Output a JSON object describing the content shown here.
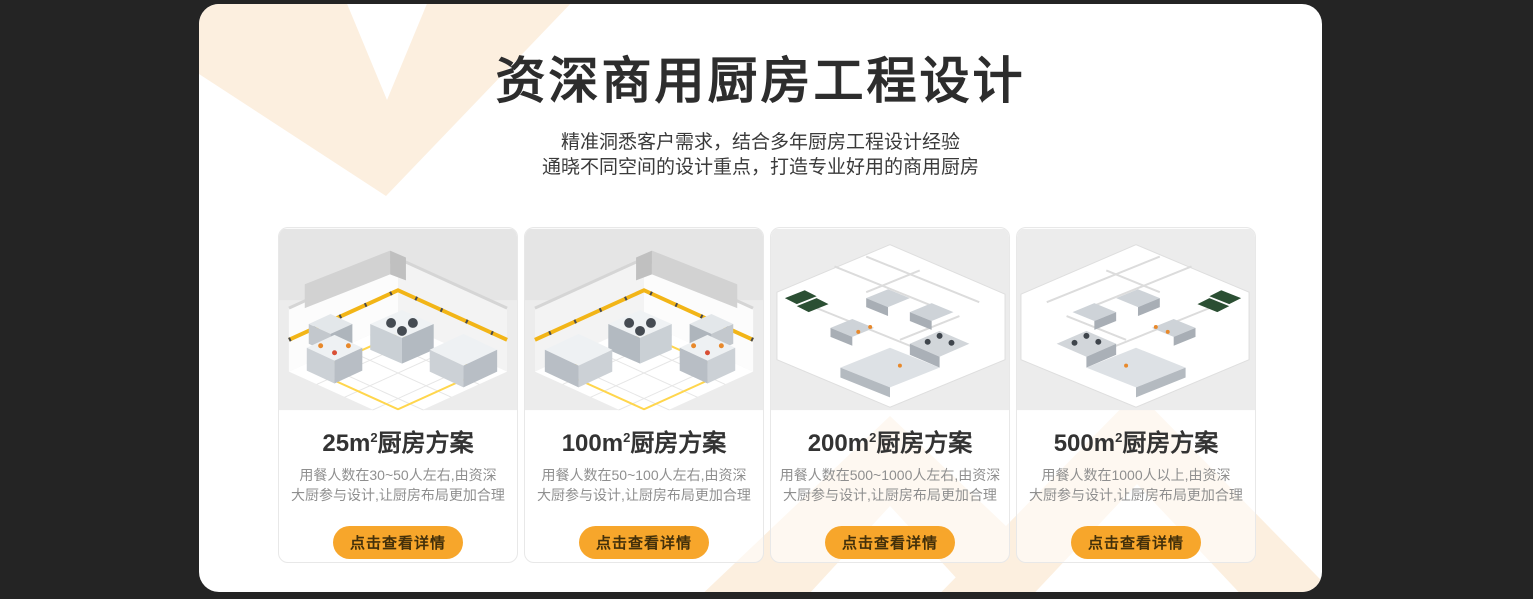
{
  "theme": {
    "page_background": "#242424",
    "panel_background": "#ffffff",
    "decoration_peach": "#fcefdf",
    "button_orange": "#f7a62b",
    "button_text_color": "#43300a",
    "title_color": "#2d2d2d",
    "description_color": "#8f8f8f",
    "tape_yellow": "#f2b517"
  },
  "header": {
    "title": "资深商用厨房工程设计",
    "subtitle_line1": "精准洞悉客户需求，结合多年厨房工程设计经验",
    "subtitle_line2": "通晓不同空间的设计重点，打造专业好用的商用厨房"
  },
  "cards": [
    {
      "title_prefix": "25m",
      "title_sup": "2",
      "title_suffix": "厨房方案",
      "desc_line1": "用餐人数在30~50人左右,由资深",
      "desc_line2": "大厨参与设计,让厨房布局更加合理",
      "button_label": "点击查看详情"
    },
    {
      "title_prefix": "100m",
      "title_sup": "2",
      "title_suffix": "厨房方案",
      "desc_line1": "用餐人数在50~100人左右,由资深",
      "desc_line2": "大厨参与设计,让厨房布局更加合理",
      "button_label": "点击查看详情"
    },
    {
      "title_prefix": "200m",
      "title_sup": "2",
      "title_suffix": "厨房方案",
      "desc_line1": "用餐人数在500~1000人左右,由资深",
      "desc_line2": "大厨参与设计,让厨房布局更加合理",
      "button_label": "点击查看详情"
    },
    {
      "title_prefix": "500m",
      "title_sup": "2",
      "title_suffix": "厨房方案",
      "desc_line1": "用餐人数在1000人以上,由资深",
      "desc_line2": "大厨参与设计,让厨房布局更加合理",
      "button_label": "点击查看详情"
    }
  ]
}
